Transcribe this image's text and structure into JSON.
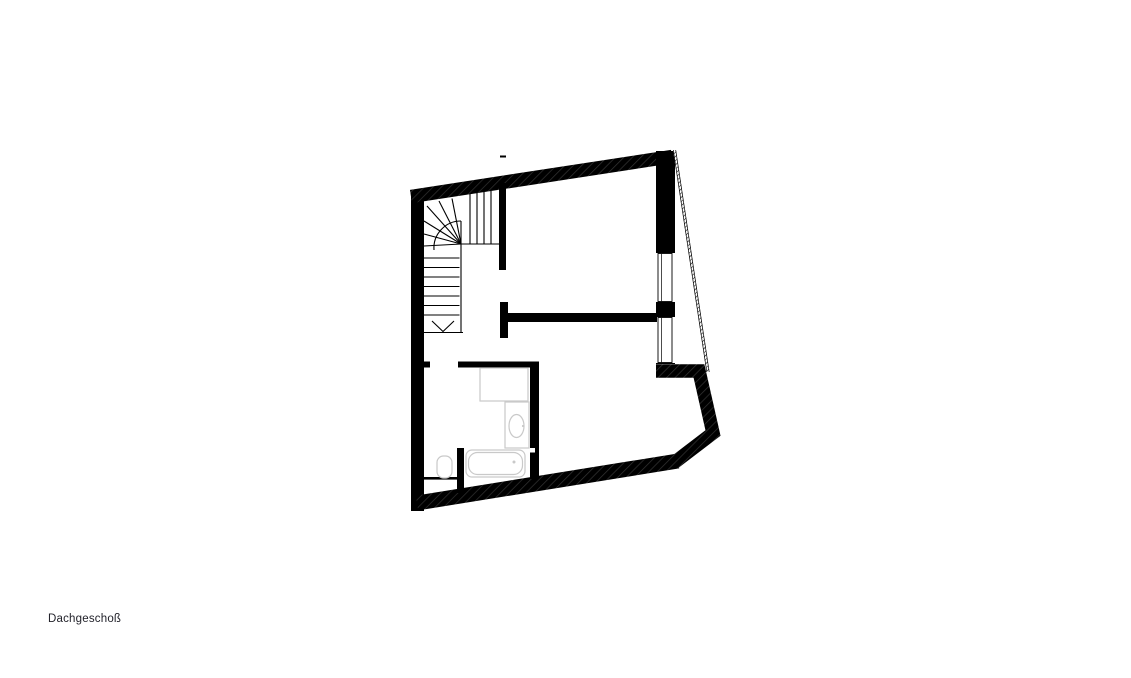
{
  "page": {
    "background_color": "#ffffff"
  },
  "plan": {
    "label": "Dachgeschoß",
    "colors": {
      "page-bg": "#ffffff",
      "wall": "#000000",
      "hatch": "#343434",
      "fixture": "#c9c9c9",
      "label-text": "#23232b"
    },
    "elements": {
      "fixtures": [
        "staircase-winder",
        "bathtub",
        "washbasin",
        "toilet",
        "shower-tray"
      ],
      "windows": [
        "window-upper-right",
        "window-lower-right"
      ],
      "stair_direction_arrow": "down"
    }
  }
}
